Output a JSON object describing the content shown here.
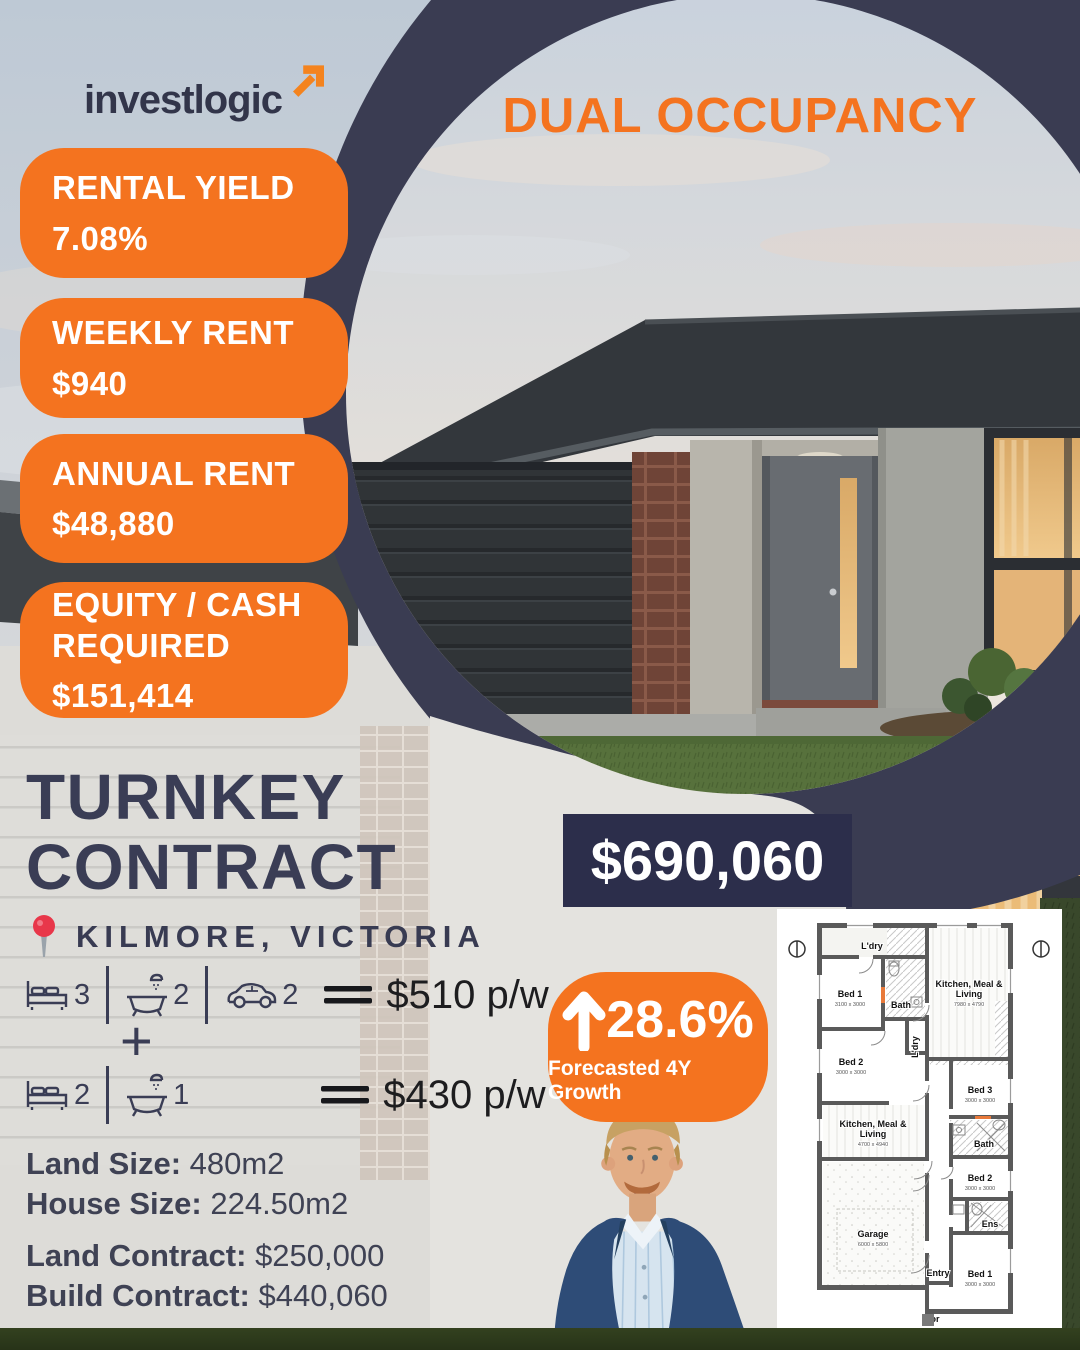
{
  "brand": {
    "logo_text": "investlogic"
  },
  "banner": "DUAL OCCUPANCY",
  "stats": [
    {
      "label": "RENTAL YIELD",
      "value": "7.08%"
    },
    {
      "label": "WEEKLY RENT",
      "value": "$940"
    },
    {
      "label": "ANNUAL RENT",
      "value": "$48,880"
    },
    {
      "label": "EQUITY / CASH REQUIRED",
      "value": "$151,414"
    }
  ],
  "title": {
    "line1": "TURNKEY",
    "line2": "CONTRACT"
  },
  "price": "$690,060",
  "location": "KILMORE, VICTORIA",
  "spec_rows": [
    {
      "beds": "3",
      "baths": "2",
      "cars": "2",
      "rent": "$510 p/w"
    },
    {
      "beds": "2",
      "baths": "1",
      "rent": "$430 p/w"
    }
  ],
  "plus_sign": "+",
  "growth": {
    "value": "28.6%",
    "label": "Forecasted 4Y Growth"
  },
  "details": [
    {
      "label": "Land Size:",
      "value": "480m2"
    },
    {
      "label": "House Size:",
      "value": "224.50m2"
    },
    {
      "label": "Land Contract:",
      "value": "$250,000"
    },
    {
      "label": "Build Contract:",
      "value": "$440,060"
    }
  ],
  "floorplan": {
    "rooms": [
      {
        "l1": "L'dry"
      },
      {
        "l1": "Bed 1",
        "dim": "3100 x 3000"
      },
      {
        "l1": "Bath"
      },
      {
        "l1": "Kitchen, Meal &",
        "l2": "Living",
        "dim": "7980 x 4790"
      },
      {
        "l1": "Bed 2",
        "dim": "3000 x 3000"
      },
      {
        "l1": "L'dry"
      },
      {
        "l1": "Bed 3",
        "dim": "3000 x 3000"
      },
      {
        "l1": "Kitchen, Meal &",
        "l2": "Living",
        "dim": "4700 x 4940"
      },
      {
        "l1": "Bath"
      },
      {
        "l1": "Bed 2",
        "dim": "3000 x 3000"
      },
      {
        "l1": "Garage",
        "dim": "6000 x 5800"
      },
      {
        "l1": "Ens"
      },
      {
        "l1": "Entry"
      },
      {
        "l1": "Bed 1",
        "dim": "3000 x 3000"
      },
      {
        "l1": "Por"
      }
    ]
  },
  "colors": {
    "accent_orange": "#F4731F",
    "navy_ring": "#3A3C52",
    "price_bg": "#2C2E4B",
    "ink": "#3A3D55"
  }
}
